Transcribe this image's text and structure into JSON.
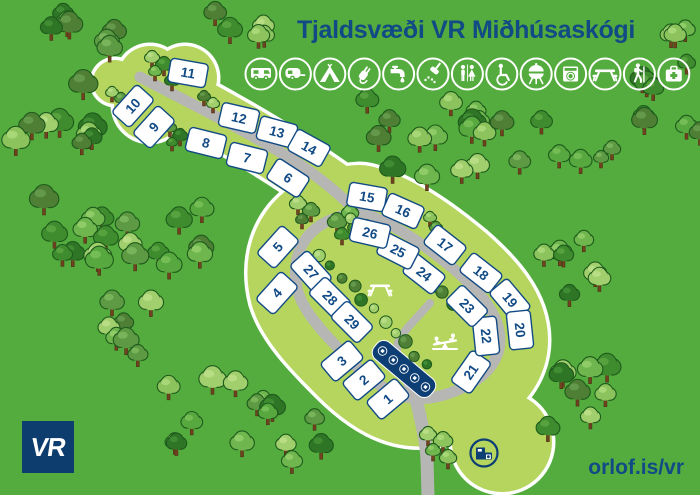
{
  "title": "Tjaldsvæði VR Miðhúsaskógi",
  "brand": {
    "logo": "VR",
    "website": "orlof.is/vr"
  },
  "colors": {
    "background": "#53ac3d",
    "camp_area": "#b6d55e",
    "road": "#b6b6b4",
    "navy": "#0d3e74",
    "text_blue": "#114a85",
    "white": "#ffffff"
  },
  "amenities": [
    "motorhome",
    "caravan",
    "tent",
    "electricity",
    "water-tap",
    "shower",
    "toilets",
    "accessible",
    "bbq",
    "laundry",
    "picnic",
    "hiking",
    "first-aid"
  ],
  "sites": [
    {
      "n": "1",
      "x": 388,
      "y": 399,
      "rot": -40
    },
    {
      "n": "2",
      "x": 364,
      "y": 380,
      "rot": -40
    },
    {
      "n": "3",
      "x": 342,
      "y": 361,
      "rot": -40
    },
    {
      "n": "4",
      "x": 277,
      "y": 293,
      "rot": -48
    },
    {
      "n": "5",
      "x": 278,
      "y": 247,
      "rot": -48
    },
    {
      "n": "6",
      "x": 288,
      "y": 178,
      "rot": 33
    },
    {
      "n": "7",
      "x": 247,
      "y": 158,
      "rot": 14
    },
    {
      "n": "8",
      "x": 206,
      "y": 143,
      "rot": 14
    },
    {
      "n": "9",
      "x": 154,
      "y": 127,
      "rot": -48
    },
    {
      "n": "10",
      "x": 133,
      "y": 106,
      "rot": -48
    },
    {
      "n": "11",
      "x": 188,
      "y": 73,
      "rot": 10
    },
    {
      "n": "12",
      "x": 239,
      "y": 118,
      "rot": 13
    },
    {
      "n": "13",
      "x": 277,
      "y": 132,
      "rot": 15
    },
    {
      "n": "14",
      "x": 309,
      "y": 148,
      "rot": 29
    },
    {
      "n": "15",
      "x": 367,
      "y": 197,
      "rot": 10
    },
    {
      "n": "16",
      "x": 403,
      "y": 211,
      "rot": 24
    },
    {
      "n": "17",
      "x": 445,
      "y": 245,
      "rot": 38
    },
    {
      "n": "18",
      "x": 481,
      "y": 273,
      "rot": 38
    },
    {
      "n": "19",
      "x": 510,
      "y": 300,
      "rot": 50
    },
    {
      "n": "20",
      "x": 520,
      "y": 330,
      "rot": 84
    },
    {
      "n": "21",
      "x": 471,
      "y": 372,
      "rot": -55
    },
    {
      "n": "22",
      "x": 486,
      "y": 336,
      "rot": 84
    },
    {
      "n": "23",
      "x": 467,
      "y": 306,
      "rot": 45
    },
    {
      "n": "24",
      "x": 424,
      "y": 274,
      "rot": 38
    },
    {
      "n": "25",
      "x": 398,
      "y": 251,
      "rot": 27
    },
    {
      "n": "26",
      "x": 370,
      "y": 233,
      "rot": 13
    },
    {
      "n": "27",
      "x": 311,
      "y": 272,
      "rot": 48
    },
    {
      "n": "28",
      "x": 330,
      "y": 298,
      "rot": 45
    },
    {
      "n": "29",
      "x": 352,
      "y": 322,
      "rot": 45
    }
  ],
  "map": {
    "features": [
      {
        "type": "picnic-table",
        "x": 380,
        "y": 289
      },
      {
        "type": "playground",
        "x": 445,
        "y": 343
      },
      {
        "type": "service-building",
        "x": 484,
        "y": 453
      },
      {
        "type": "services-sign",
        "x": 404,
        "y": 369,
        "rot": 40,
        "icons": [
          "caravan",
          "water-tap",
          "accessible",
          "laundry",
          "shower"
        ]
      }
    ],
    "bush_rows": [
      {
        "x1": 352,
        "y1": 217,
        "x2": 490,
        "y2": 331,
        "count": 13
      },
      {
        "x1": 322,
        "y1": 253,
        "x2": 424,
        "y2": 367,
        "count": 11
      }
    ],
    "tree_clusters": [
      {
        "x": 50,
        "y": 5,
        "w": 75,
        "h": 50,
        "count": 7,
        "rmin": 9,
        "rmax": 13
      },
      {
        "x": 210,
        "y": 8,
        "w": 60,
        "h": 40,
        "count": 5,
        "rmin": 9,
        "rmax": 12
      },
      {
        "x": 8,
        "y": 70,
        "w": 85,
        "h": 80,
        "count": 9,
        "rmin": 9,
        "rmax": 14
      },
      {
        "x": 10,
        "y": 175,
        "w": 110,
        "h": 85,
        "count": 9,
        "rmin": 9,
        "rmax": 14
      },
      {
        "x": 95,
        "y": 195,
        "w": 135,
        "h": 75,
        "count": 10,
        "rmin": 9,
        "rmax": 13
      },
      {
        "x": 105,
        "y": 283,
        "w": 90,
        "h": 72,
        "count": 7,
        "rmin": 9,
        "rmax": 13
      },
      {
        "x": 165,
        "y": 375,
        "w": 80,
        "h": 78,
        "count": 7,
        "rmin": 9,
        "rmax": 13
      },
      {
        "x": 252,
        "y": 390,
        "w": 100,
        "h": 70,
        "count": 8,
        "rmin": 9,
        "rmax": 12
      },
      {
        "x": 525,
        "y": 362,
        "w": 95,
        "h": 82,
        "count": 8,
        "rmin": 9,
        "rmax": 13
      },
      {
        "x": 538,
        "y": 238,
        "w": 90,
        "h": 65,
        "count": 7,
        "rmin": 9,
        "rmax": 12
      },
      {
        "x": 628,
        "y": 75,
        "w": 72,
        "h": 68,
        "count": 7,
        "rmin": 9,
        "rmax": 12
      },
      {
        "x": 652,
        "y": 12,
        "w": 48,
        "h": 55,
        "count": 4,
        "rmin": 8,
        "rmax": 11
      },
      {
        "x": 362,
        "y": 96,
        "w": 115,
        "h": 80,
        "count": 11,
        "rmin": 9,
        "rmax": 13
      },
      {
        "x": 470,
        "y": 95,
        "w": 120,
        "h": 75,
        "count": 9,
        "rmin": 9,
        "rmax": 12
      }
    ],
    "tree_groups": [
      [
        [
          152,
          57,
          7
        ],
        [
          164,
          64,
          8
        ],
        [
          155,
          71,
          6
        ],
        [
          172,
          80,
          7
        ]
      ],
      [
        [
          112,
          92,
          6
        ],
        [
          121,
          98,
          6
        ]
      ],
      [
        [
          204,
          96,
          6
        ],
        [
          213,
          103,
          6
        ]
      ],
      [
        [
          170,
          127,
          6
        ],
        [
          180,
          135,
          7
        ],
        [
          172,
          142,
          5
        ]
      ],
      [
        [
          298,
          203,
          8
        ],
        [
          311,
          210,
          8
        ],
        [
          302,
          219,
          6
        ]
      ],
      [
        [
          430,
          217,
          6
        ],
        [
          436,
          227,
          6
        ]
      ],
      [
        [
          337,
          221,
          9
        ],
        [
          350,
          212,
          8
        ],
        [
          342,
          234,
          7
        ],
        [
          354,
          227,
          6
        ]
      ],
      [
        [
          428,
          434,
          8
        ],
        [
          443,
          440,
          9
        ],
        [
          433,
          450,
          7
        ],
        [
          448,
          457,
          8
        ]
      ],
      [
        [
          612,
          148,
          8
        ],
        [
          601,
          157,
          7
        ]
      ]
    ]
  }
}
